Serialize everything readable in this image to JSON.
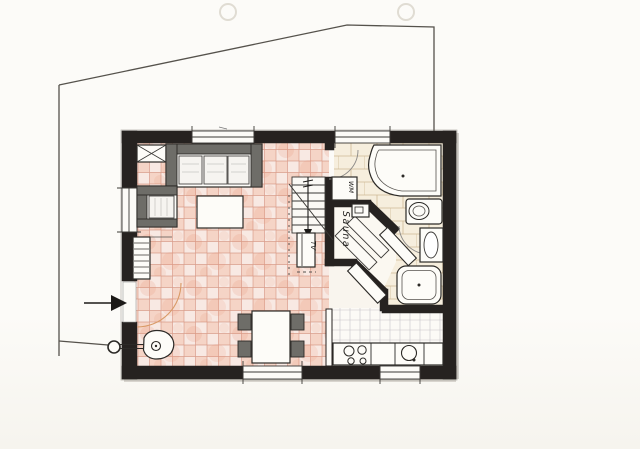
{
  "plan": {
    "labels": {
      "sauna": "Sauna",
      "washing_machine": "WM",
      "tv": "TV"
    },
    "colors": {
      "paper": "#fbfaf6",
      "wall_ink": "#262220",
      "boundary_line": "#55524c",
      "living_tile_base": "#f8e9e3",
      "living_tile_accent": "#eda084",
      "tile_grid_line": "#c97a64",
      "bath_tile_base": "#f6eedd",
      "bath_tile_line": "#c3ab82",
      "kitchen_tile_line": "#9a96a4",
      "furniture_frame": "#6e6d68",
      "fixture_fill": "#fdfcf8",
      "door_swing_pencil": "#d99a66"
    }
  }
}
